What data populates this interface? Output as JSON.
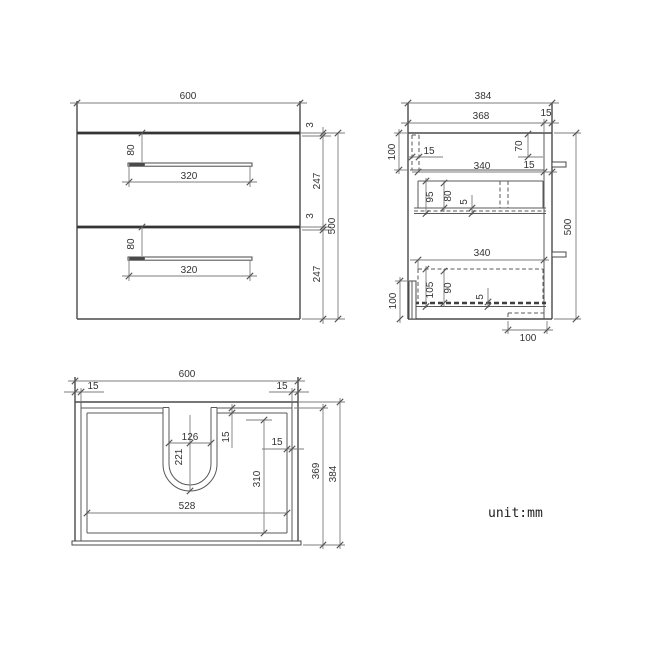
{
  "note": {
    "unit": "unit:mm"
  },
  "front_view": {
    "width": "600",
    "height": "500",
    "top_gap": "3",
    "drawer1_height": "247",
    "mid_gap": "3",
    "drawer2_height": "247",
    "drawers": [
      {
        "handle_offset": "80",
        "handle_width": "320"
      },
      {
        "handle_offset": "80",
        "handle_width": "320"
      }
    ]
  },
  "side_view": {
    "depth": "384",
    "inner_depth": "368",
    "back_panel": "15",
    "top_rail_height": "100",
    "top_rail_thickness": "15",
    "bracket_offset": "70",
    "bracket_gap": "15",
    "height": "500",
    "drawer1": {
      "depth": "340",
      "side_height": "95",
      "inner_height": "80",
      "bottom_thickness": "5"
    },
    "drawer2": {
      "depth": "340",
      "side_height": "105",
      "inner_height": "90",
      "bottom_thickness": "5"
    },
    "bottom_rail_height": "100",
    "base_notch_width": "100"
  },
  "top_view": {
    "width": "600",
    "left_wall": "15",
    "right_wall": "15",
    "cutout_width": "126",
    "cutout_depth": "221",
    "back_rail": "15",
    "side_clearance": "15",
    "clear_depth": "310",
    "inner_width": "528",
    "inner_depth": "369",
    "depth": "384"
  }
}
